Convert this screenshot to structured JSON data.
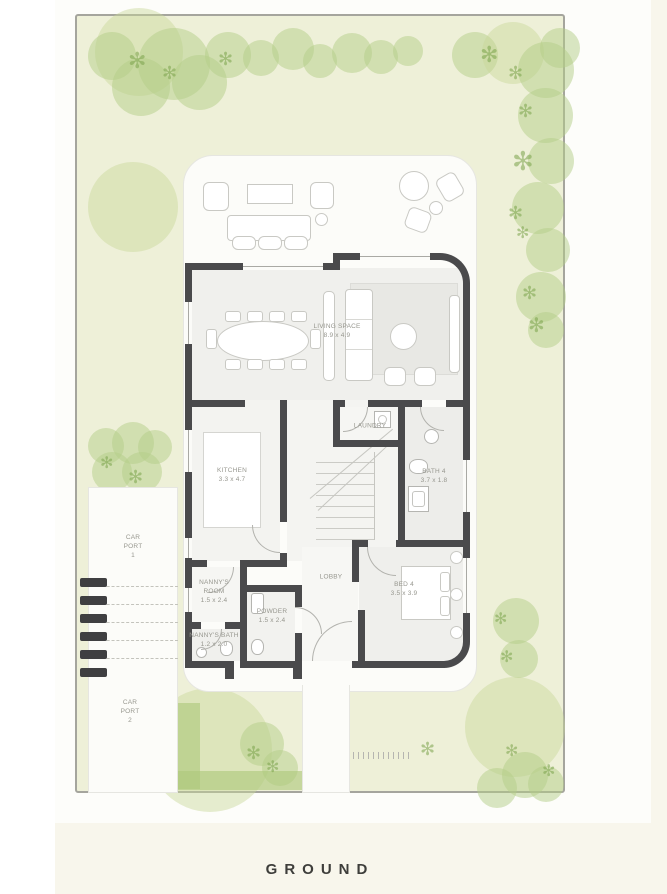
{
  "caption": "GROUND",
  "icons": {
    "leaf": "✻"
  },
  "colors": {
    "wall": "#4a4a4c",
    "lawn": "#eef0d8",
    "foliage": "#b4cd87",
    "page_background": "#f8f6ec"
  },
  "rooms": {
    "living": {
      "name": "LIVING SPACE",
      "dims": "8.9 x 4.9"
    },
    "kitchen": {
      "name": "KITCHEN",
      "dims": "3.3 x 4.7"
    },
    "laundry": {
      "name": "LAUNDRY",
      "dims": ""
    },
    "bath4": {
      "name": "BATH 4",
      "dims": "3.7 x 1.8"
    },
    "bed4": {
      "name": "BED 4",
      "dims": "3.5 x 3.9"
    },
    "nannys_room": {
      "name": "NANNY'S ROOM",
      "dims": "1.5 x 2.4"
    },
    "nannys_bath": {
      "name": "NANNY'S BATH",
      "dims": "1.2 x 2.0"
    },
    "powder": {
      "name": "POWDER",
      "dims": "1.5 x 2.4"
    },
    "lobby": {
      "name": "LOBBY",
      "dims": ""
    },
    "carport1": {
      "name": "CAR PORT",
      "number": "1"
    },
    "carport2": {
      "name": "CAR PORT",
      "number": "2"
    }
  }
}
